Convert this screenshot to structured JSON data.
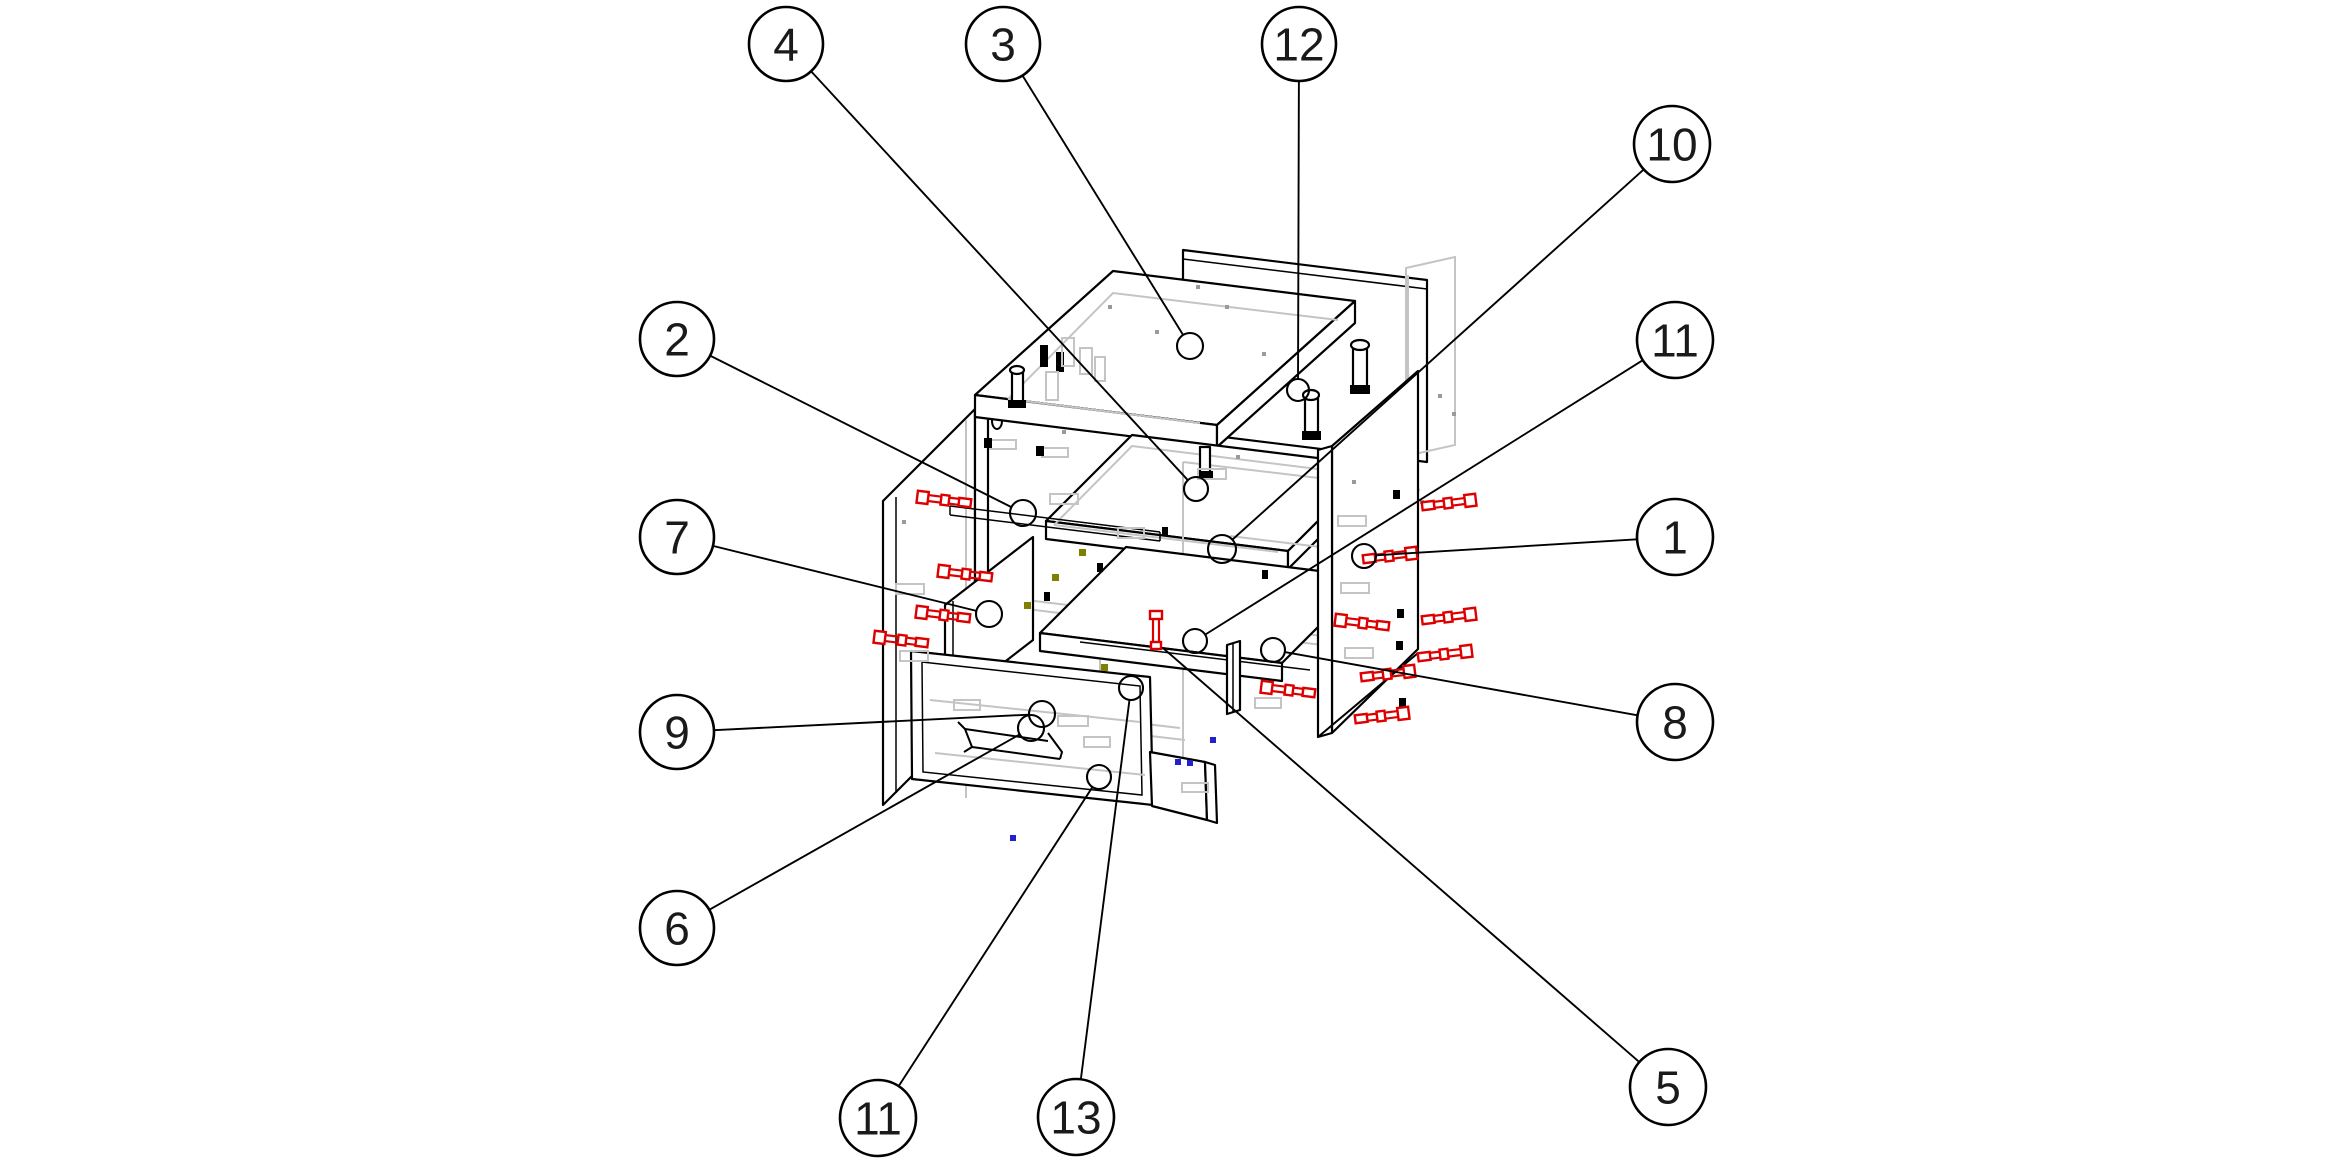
{
  "diagram": {
    "type": "exploded-assembly-drawing",
    "subject": "cabinet with drawers exploded view with numbered part callouts",
    "background": "#ffffff",
    "colors": {
      "line": "#000000",
      "ghost": "#c4c4c4",
      "fastener_red": "#dd0000",
      "dot_blue": "#2222cc",
      "dot_olive": "#7f7f00"
    },
    "balloons": [
      {
        "id": "b4",
        "label": "4",
        "cx": 786,
        "cy": 44,
        "r": 37,
        "target": {
          "x": 1196,
          "y": 489,
          "r": 12
        }
      },
      {
        "id": "b3",
        "label": "3",
        "cx": 1003,
        "cy": 44,
        "r": 37,
        "target": {
          "x": 1190,
          "y": 346,
          "r": 13
        }
      },
      {
        "id": "b12",
        "label": "12",
        "cx": 1299,
        "cy": 44,
        "r": 37,
        "target": {
          "x": 1298,
          "y": 390,
          "r": 11
        }
      },
      {
        "id": "b10",
        "label": "10",
        "cx": 1672,
        "cy": 144,
        "r": 38,
        "target": {
          "x": 1222,
          "y": 549,
          "r": 14
        }
      },
      {
        "id": "b11r",
        "label": "11",
        "cx": 1675,
        "cy": 340,
        "r": 38,
        "target": {
          "x": 1195,
          "y": 641,
          "r": 12
        }
      },
      {
        "id": "b1",
        "label": "1",
        "cx": 1675,
        "cy": 537,
        "r": 38,
        "target": {
          "x": 1364,
          "y": 556,
          "r": 12
        }
      },
      {
        "id": "b8",
        "label": "8",
        "cx": 1675,
        "cy": 722,
        "r": 38,
        "target": {
          "x": 1273,
          "y": 650,
          "r": 12
        }
      },
      {
        "id": "b5",
        "label": "5",
        "cx": 1668,
        "cy": 1087,
        "r": 38,
        "target": {
          "x": 1163,
          "y": 648,
          "r": 0
        }
      },
      {
        "id": "b2",
        "label": "2",
        "cx": 677,
        "cy": 339,
        "r": 37,
        "target": {
          "x": 1023,
          "y": 513,
          "r": 13
        }
      },
      {
        "id": "b7",
        "label": "7",
        "cx": 677,
        "cy": 537,
        "r": 37,
        "target": {
          "x": 989,
          "y": 614,
          "r": 13
        }
      },
      {
        "id": "b9",
        "label": "9",
        "cx": 677,
        "cy": 732,
        "r": 37,
        "target": {
          "x": 1042,
          "y": 714,
          "r": 13
        }
      },
      {
        "id": "b6",
        "label": "6",
        "cx": 677,
        "cy": 928,
        "r": 37,
        "target": {
          "x": 1031,
          "y": 728,
          "r": 13
        }
      },
      {
        "id": "b11l",
        "label": "11",
        "cx": 878,
        "cy": 1118,
        "r": 38,
        "target": {
          "x": 1099,
          "y": 777,
          "r": 12
        }
      },
      {
        "id": "b13",
        "label": "13",
        "cx": 1076,
        "cy": 1117,
        "r": 38,
        "target": {
          "x": 1131,
          "y": 688,
          "r": 12
        }
      }
    ],
    "fasteners_horizontal": [
      {
        "cx": 944,
        "cy": 500,
        "dir": 1
      },
      {
        "cx": 965,
        "cy": 574,
        "dir": 1
      },
      {
        "cx": 943,
        "cy": 615,
        "dir": 1
      },
      {
        "cx": 901,
        "cy": 640,
        "dir": 1
      },
      {
        "cx": 1449,
        "cy": 503,
        "dir": -1
      },
      {
        "cx": 1390,
        "cy": 556,
        "dir": -1
      },
      {
        "cx": 1362,
        "cy": 623,
        "dir": 1
      },
      {
        "cx": 1449,
        "cy": 617,
        "dir": -1
      },
      {
        "cx": 1445,
        "cy": 654,
        "dir": -1
      },
      {
        "cx": 1388,
        "cy": 674,
        "dir": -1
      },
      {
        "cx": 1288,
        "cy": 690,
        "dir": 1
      },
      {
        "cx": 1382,
        "cy": 716,
        "dir": -1
      }
    ],
    "fasteners_vertical": [
      {
        "cx": 1156,
        "cy": 628
      }
    ],
    "dots_blue": [
      {
        "x": 1178,
        "y": 762
      },
      {
        "x": 1190,
        "y": 763
      },
      {
        "x": 1213,
        "y": 740
      },
      {
        "x": 1013,
        "y": 838
      }
    ],
    "dots_olive": [
      {
        "x": 1082,
        "y": 552
      },
      {
        "x": 1055,
        "y": 577
      },
      {
        "x": 1027,
        "y": 605
      },
      {
        "x": 1104,
        "y": 667
      }
    ],
    "parts": [
      "back-panel",
      "top-panel",
      "middle-shelf",
      "left-side-panel",
      "right-side-panel",
      "front-rail",
      "drawer-front-large",
      "drawer-front-small",
      "bottom-panel",
      "center-divider",
      "drawer-runner",
      "hinge",
      "drawer-lock-bracket"
    ]
  }
}
